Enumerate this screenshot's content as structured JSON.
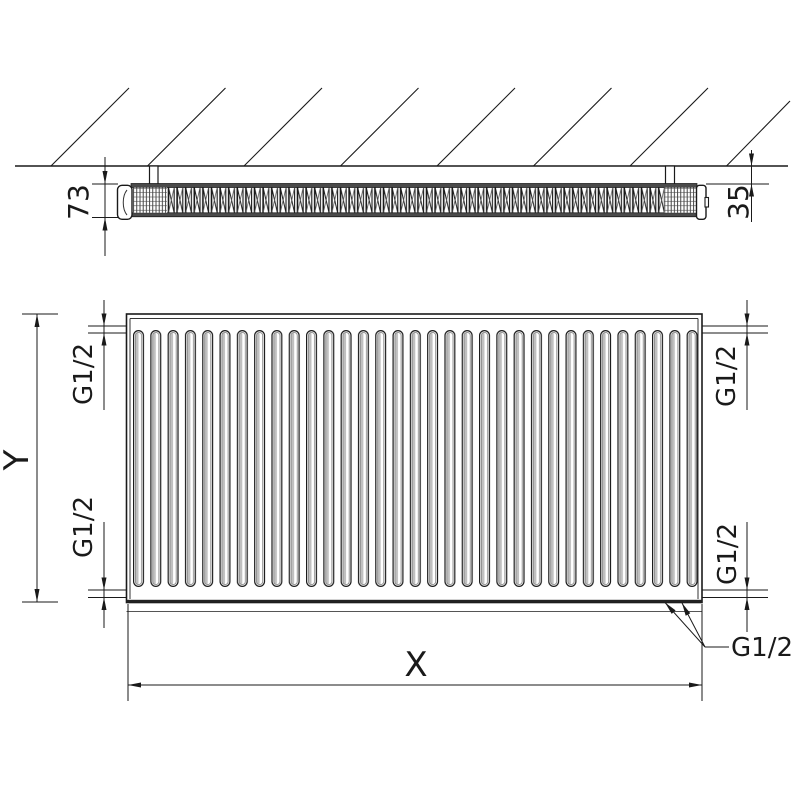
{
  "drawing": {
    "side_view": {
      "depth_dim": "73",
      "wall_distance_dim": "35"
    },
    "front_view": {
      "height_dim": "Y",
      "width_dim": "X",
      "thread_top_left": "G1/2",
      "thread_top_right": "G1/2",
      "thread_bottom_left": "G1/2",
      "thread_bottom_right": "G1/2",
      "thread_bottom_ports": "G1/2"
    },
    "colors": {
      "line": "#1a1a1a",
      "background": "#ffffff",
      "rail_fill": "#4a4a4a",
      "slot_shade": "#c0c0c0"
    }
  }
}
